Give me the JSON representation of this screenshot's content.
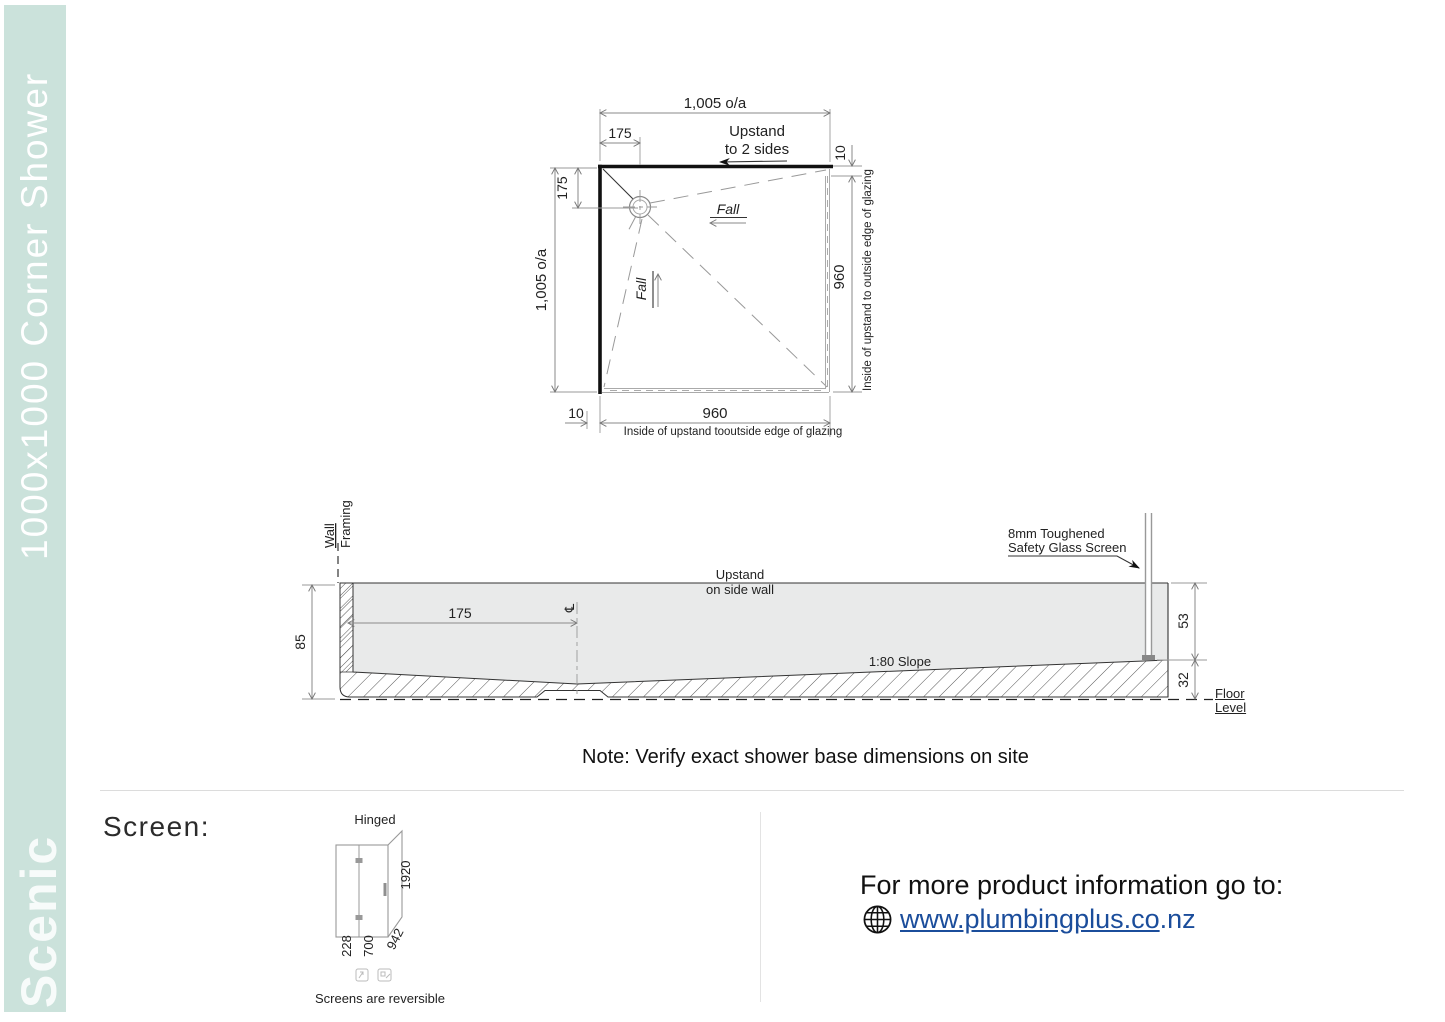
{
  "sidebar": {
    "title": "1000x1000 Corner Shower",
    "brand": "Scenic"
  },
  "plan": {
    "dim_top_overall": "1,005 o/a",
    "dim_top_drain": "175",
    "upstand_note": [
      "Upstand",
      "to 2 sides"
    ],
    "dim_right_gap": "10",
    "dim_right_glazing": "960",
    "caption_right": "Inside of upstand to outside edge of glazing",
    "dim_left_overall": "1,005 o/a",
    "dim_left_drain": "175",
    "dim_bottom_gap": "10",
    "dim_bottom_glazing": "960",
    "caption_bottom": "Inside of upstand tooutside edge of glazing",
    "fall_horizontal": "Fall",
    "fall_vertical": "Fall"
  },
  "section": {
    "wall_framing": [
      "Wall",
      "Framing"
    ],
    "dim_total_height": "85",
    "dim_drain_offset": "175",
    "centerline_symbol": "℄",
    "upstand_note": [
      "Upstand",
      "on side wall"
    ],
    "slope_label": "1:80 Slope",
    "glass_note": [
      "8mm Toughened",
      "Safety Glass Screen"
    ],
    "dim_upstand_height": "53",
    "dim_base_edge_height": "32",
    "floor_level": "Floor Level"
  },
  "note": "Note: Verify exact shower base dimensions on site",
  "screen": {
    "heading": "Screen:",
    "type_label": "Hinged",
    "dim_height": "1920",
    "dim_door": "228",
    "dim_panel": "700",
    "dim_return": "942",
    "reversible_note": "Screens are reversible"
  },
  "footer": {
    "prompt": "For more product information go to:",
    "link": "www.plumbingplus.co",
    "link_suffix": ".nz"
  },
  "colors": {
    "sidebar_bg": "#cbe2db",
    "link": "#1b4d9b"
  }
}
